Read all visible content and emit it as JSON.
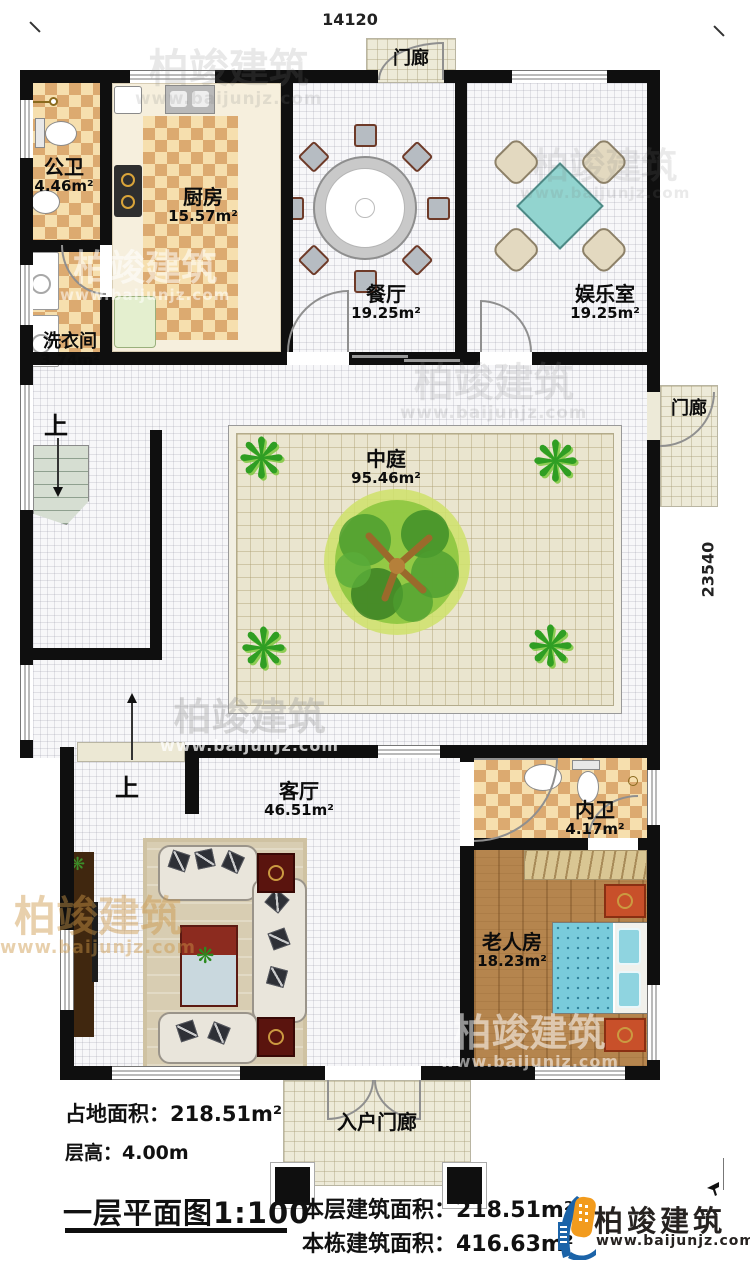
{
  "dimensions": {
    "top": "14120",
    "right": "23540"
  },
  "stairs": {
    "up_upper": "上",
    "up_lower": "上"
  },
  "rooms": {
    "porch_top": {
      "name": "门廊"
    },
    "public_bath": {
      "name": "公卫",
      "area": "4.46m²"
    },
    "kitchen": {
      "name": "厨房",
      "area": "15.57m²"
    },
    "laundry": {
      "name": "洗衣间",
      "area": "3.74m²"
    },
    "dining": {
      "name": "餐厅",
      "area": "19.25m²"
    },
    "entertainment": {
      "name": "娱乐室",
      "area": "19.25m²"
    },
    "porch_right": {
      "name": "门廊"
    },
    "atrium": {
      "name": "中庭",
      "area": "95.46m²"
    },
    "living": {
      "name": "客厅",
      "area": "46.51m²"
    },
    "inner_bath": {
      "name": "内卫",
      "area": "4.17m²"
    },
    "elder_room": {
      "name": "老人房",
      "area": "18.23m²"
    },
    "entry_porch": {
      "name": "入户门廊"
    }
  },
  "footer": {
    "land_area": "占地面积：218.51m²",
    "floor_height": "层高：4.00m",
    "plan_title": "一层平面图1:100",
    "floor_area": "本层建筑面积：218.51m²",
    "building_area": "本栋建筑面积：416.63m²"
  },
  "logo": {
    "brand": "柏竣建筑",
    "url": "www.baijunjz.com"
  },
  "watermark": {
    "brand": "柏竣建筑",
    "url": "www.baijunjz.com"
  },
  "colors": {
    "wall": "#0f0f0f",
    "checker_dark": "#dcaa70",
    "checker_light": "#f6dfae",
    "wood": "#b5854e",
    "bed": "#72c7d8",
    "game_table": "#92d4cf",
    "tree": "#4ea82e",
    "logo_blue": "#1b63a8",
    "logo_orange": "#f29b1d"
  }
}
